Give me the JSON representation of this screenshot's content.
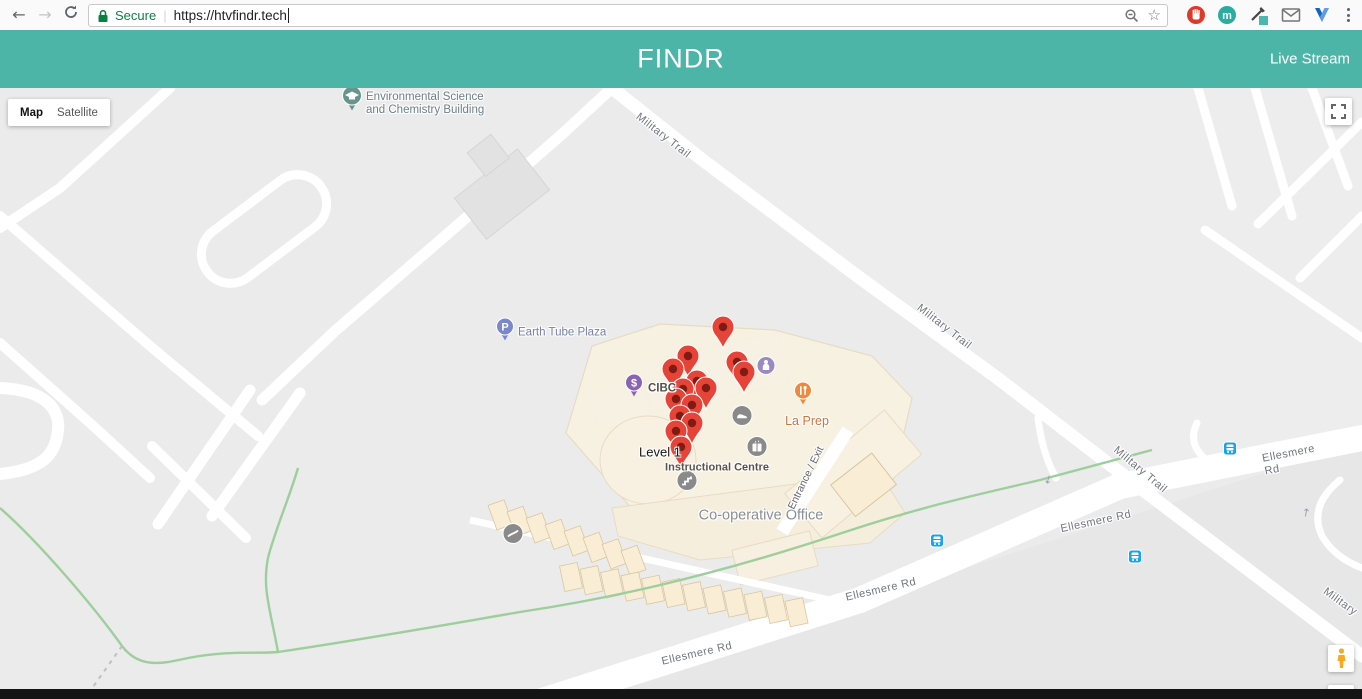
{
  "browser": {
    "secure_label": "Secure",
    "url": "https://htvfindr.tech",
    "icon_names": [
      "back-arrow",
      "forward-arrow",
      "reload",
      "lock",
      "zoom-out-magnifier",
      "bookmark-star",
      "adblock-hand",
      "m-extension",
      "color-picker",
      "mail-extension",
      "v-extension",
      "browser-menu-dots"
    ]
  },
  "header": {
    "title": "FINDR",
    "live_stream_label": "Live Stream"
  },
  "colors": {
    "header_teal": "#4cb5a8",
    "marker_red": "#e64438",
    "secure_green": "#0b8043",
    "transit_blue": "#18a4e8",
    "building_beige": "#f8f1e1"
  },
  "map": {
    "controls": {
      "map_label": "Map",
      "satellite_label": "Satellite"
    },
    "markers": [
      {
        "x": 723,
        "y": 239
      },
      {
        "x": 688,
        "y": 268
      },
      {
        "x": 737,
        "y": 274
      },
      {
        "x": 673,
        "y": 281
      },
      {
        "x": 744,
        "y": 284
      },
      {
        "x": 697,
        "y": 293
      },
      {
        "x": 706,
        "y": 300
      },
      {
        "x": 683,
        "y": 301
      },
      {
        "x": 676,
        "y": 311
      },
      {
        "x": 692,
        "y": 317
      },
      {
        "x": 680,
        "y": 328
      },
      {
        "x": 692,
        "y": 335
      },
      {
        "x": 676,
        "y": 343
      },
      {
        "x": 681,
        "y": 359
      }
    ],
    "road_labels": [
      {
        "name": "road-label-military-trail-1",
        "text": "Military Trail",
        "x": 663,
        "y": 48,
        "rot": 38
      },
      {
        "name": "road-label-military-trail-2",
        "text": "Military Trail",
        "x": 944,
        "y": 239,
        "rot": 38
      },
      {
        "name": "road-label-military-trail-3",
        "text": "Military Trail",
        "x": 1140,
        "y": 382,
        "rot": 40
      },
      {
        "name": "road-label-military-trail-4",
        "text": "Military",
        "x": 1340,
        "y": 514,
        "rot": 36
      },
      {
        "name": "road-label-ellesmere-rd-1",
        "text": "Ellesmere Rd",
        "x": 697,
        "y": 566,
        "rot": -13
      },
      {
        "name": "road-label-ellesmere-rd-2",
        "text": "Ellesmere Rd",
        "x": 881,
        "y": 502,
        "rot": -13
      },
      {
        "name": "road-label-ellesmere-rd-3",
        "text": "Ellesmere Rd",
        "x": 1096,
        "y": 434,
        "rot": -12
      },
      {
        "name": "road-label-ellesmere-rd-4",
        "text": "Ellesmere Rd",
        "x": 1296,
        "y": 371,
        "rot": -11
      }
    ],
    "place_labels": [
      {
        "name": "poi-label-env-science-building",
        "text": "Environmental Science\nand Chemistry Building",
        "x": 366,
        "y": 16,
        "cls": "lbl-school",
        "anchor": "left",
        "inter": true
      },
      {
        "name": "poi-label-earth-tube-plaza",
        "text": "Earth Tube Plaza",
        "x": 518,
        "y": 245,
        "cls": "lbl-parking",
        "anchor": "left",
        "inter": true
      },
      {
        "name": "poi-label-cibc",
        "text": "CIBC",
        "x": 648,
        "y": 301,
        "cls": "lbl-cibc",
        "anchor": "left",
        "inter": true
      },
      {
        "name": "poi-label-la-prep",
        "text": "La Prep",
        "x": 807,
        "y": 333,
        "cls": "lbl-food",
        "inter": true
      },
      {
        "name": "map-label-level-1",
        "text": "Level 1",
        "x": 660,
        "y": 365,
        "cls": "lbl-level",
        "inter": false
      },
      {
        "name": "map-label-instructional-centre",
        "text": "Instructional Centre",
        "x": 717,
        "y": 380,
        "cls": "lbl-bld",
        "inter": false
      },
      {
        "name": "map-label-co-operative-office",
        "text": "Co-operative Office",
        "x": 761,
        "y": 428,
        "cls": "lbl-area",
        "inter": false
      },
      {
        "name": "map-label-entrance-exit",
        "text": "Entrance / Exit",
        "x": 806,
        "y": 390,
        "rot": -64,
        "cls": "lbl-entrance",
        "inter": false
      }
    ],
    "transit_stops": [
      {
        "x": 937,
        "y": 455
      },
      {
        "x": 1135,
        "y": 471
      },
      {
        "x": 1230,
        "y": 363
      }
    ],
    "oneway_arrows": [
      {
        "x": 1048,
        "y": 392,
        "glyph": "↓",
        "rot": 15
      },
      {
        "x": 1306,
        "y": 425,
        "glyph": "↑",
        "rot": 10
      }
    ]
  }
}
